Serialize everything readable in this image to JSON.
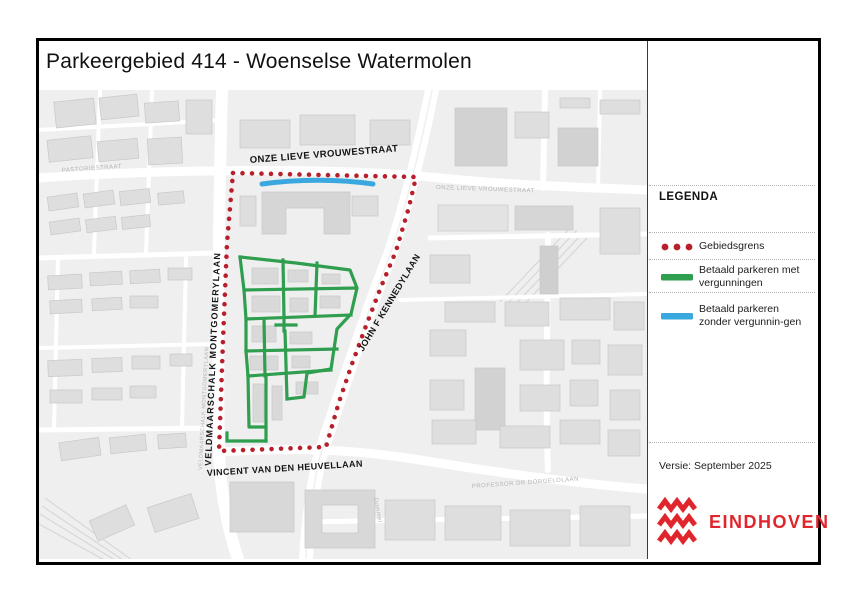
{
  "title": "Parkeergebied 414 - Woenselse Watermolen",
  "map": {
    "street_labels": {
      "top": "ONZE LIEVE VROUWESTRAAT",
      "left": "VELDMAARSCHALK MONTGOMERYLAAN",
      "right": "JOHN F KENNEDYLAAN",
      "bottom": "VINCENT VAN DEN HEUVELLAAN"
    },
    "basemap_labels": {
      "pastoriestraat": "PASTORIESTRAAT",
      "onze_lieve_vrouwestraat": "ONZE LIEVE VROUWESTRAAT",
      "professor_dr_dorgelolaan": "PROFESSOR DR DORGELOLAAN",
      "dommel": "Dommel",
      "montgomerylaan": "VELDMAARSCHALK MONTGOMERYLAAN"
    }
  },
  "legend": {
    "heading": "LEGENDA",
    "items": [
      {
        "symbol": "boundary-dots",
        "label": "Gebiedsgrens"
      },
      {
        "symbol": "green-line",
        "label": "Betaald parkeren met vergunningen"
      },
      {
        "symbol": "blue-line",
        "label": "Betaald parkeren zonder vergunnin-gen"
      }
    ]
  },
  "version": "Versie: September 2025",
  "logo": {
    "wordmark": "EINDHOVEN"
  },
  "colors": {
    "boundary": "#b81f2a",
    "permit_green": "#2f9e4f",
    "paid_blue": "#3aa8de",
    "logo_red": "#e0262c"
  }
}
